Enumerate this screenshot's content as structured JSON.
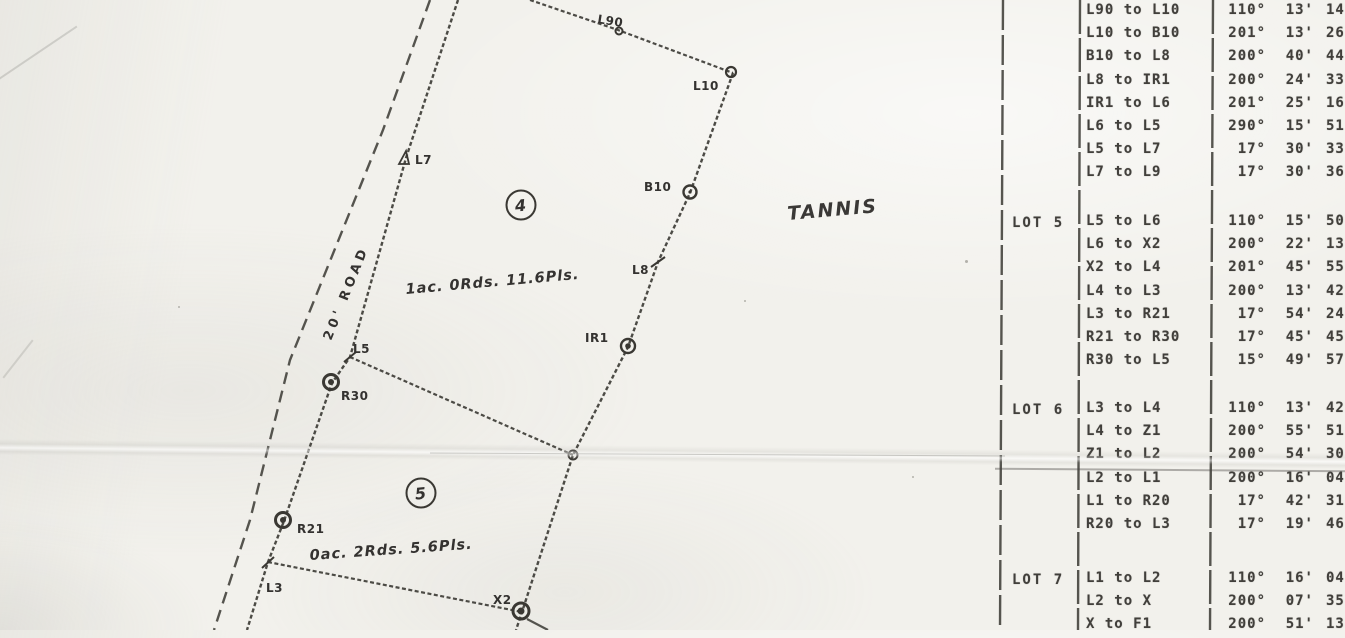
{
  "map": {
    "road_label": "20' ROAD",
    "region_label": "TANNIS",
    "lot4": {
      "number": "4",
      "area": "1ac. 0Rds. 11.6Pls."
    },
    "lot5": {
      "number": "5",
      "area": "0ac. 2Rds. 5.6Pls."
    },
    "labels": {
      "l90": "L90",
      "l10": "L10",
      "b10": "B10",
      "l8": "L8",
      "ir1": "IR1",
      "l7": "L7",
      "l5": "L5",
      "r30": "R30",
      "r21": "R21",
      "l3": "L3",
      "x2": "X2"
    }
  },
  "table": {
    "groups": [
      {
        "lot": "",
        "rows": [
          [
            "L90 to L10",
            "110°",
            "13'",
            "14"
          ],
          [
            "L10 to B10",
            "201°",
            "13'",
            "26"
          ],
          [
            "B10 to L8",
            "200°",
            "40'",
            "44"
          ],
          [
            "L8 to IR1",
            "200°",
            "24'",
            "33"
          ],
          [
            "IR1 to L6",
            "201°",
            "25'",
            "16"
          ],
          [
            "L6 to L5",
            "290°",
            "15'",
            "51"
          ],
          [
            "L5 to L7",
            "17°",
            "30'",
            "33"
          ],
          [
            "L7 to L9",
            "17°",
            "30'",
            "36"
          ]
        ]
      },
      {
        "lot": "LOT 5",
        "rows": [
          [
            "L5 to L6",
            "110°",
            "15'",
            "50"
          ],
          [
            "L6 to X2",
            "200°",
            "22'",
            "13"
          ],
          [
            "X2 to L4",
            "201°",
            "45'",
            "55"
          ],
          [
            "L4 to L3",
            "200°",
            "13'",
            "42"
          ],
          [
            "L3 to R21",
            "17°",
            "54'",
            "24"
          ],
          [
            "R21 to R30",
            "17°",
            "45'",
            "45"
          ],
          [
            "R30 to L5",
            "15°",
            "49'",
            "57"
          ]
        ]
      },
      {
        "lot": "LOT 6",
        "rows": [
          [
            "L3 to L4",
            "110°",
            "13'",
            "42"
          ],
          [
            "L4 to Z1",
            "200°",
            "55'",
            "51"
          ],
          [
            "Z1 to L2",
            "200°",
            "54'",
            "30"
          ],
          [
            "L2 to L1",
            "200°",
            "16'",
            "04"
          ],
          [
            "L1 to R20",
            "17°",
            "42'",
            "31"
          ],
          [
            "R20 to L3",
            "17°",
            "19'",
            "46"
          ]
        ]
      },
      {
        "lot": "LOT 7",
        "rows": [
          [
            "L1 to L2",
            "110°",
            "16'",
            "04"
          ],
          [
            "L2 to X",
            "200°",
            "07'",
            "35"
          ],
          [
            "X to F1",
            "200°",
            "51'",
            "13"
          ]
        ]
      }
    ]
  }
}
